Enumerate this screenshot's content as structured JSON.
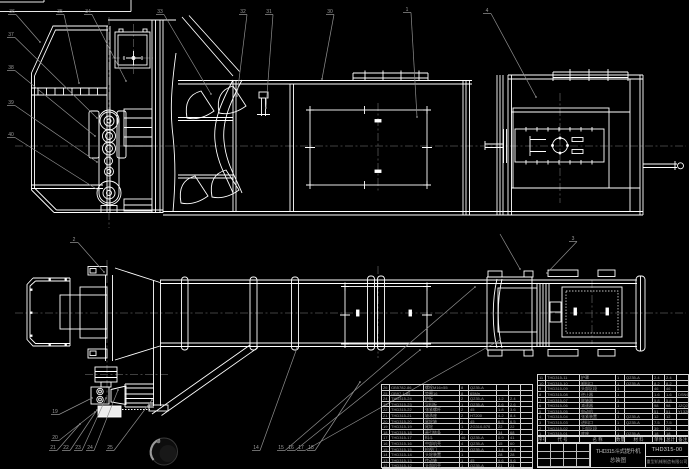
{
  "drawing": {
    "product_title": "THD315斗式提升机",
    "drawing_type": "总装图",
    "drawing_no": "THD315-00",
    "company": "重型机械制造有限公司"
  },
  "colors": {
    "background": "#000000",
    "line": "#ffffff",
    "annotation_gray": "#8f8f8f",
    "centerline_gray": "#565656",
    "table_text": "#a0a0a0"
  },
  "bom_headers": [
    "序号",
    "代  号",
    "名  称",
    "数量",
    "材  料",
    "单件",
    "总计",
    "备注"
  ],
  "bom_left": {
    "rows": [
      [
        "26",
        "GB5782-86",
        "螺栓M16×55",
        "8",
        "Q235-A",
        "",
        "",
        ""
      ],
      [
        "25",
        "GB97.1-85",
        "垫圈16",
        "8",
        "65Mn",
        "",
        "",
        ""
      ],
      [
        "24",
        "THD315-24",
        "护板",
        "2",
        "Q235-A",
        "1.2",
        "2.4",
        ""
      ],
      [
        "23",
        "THD315-23",
        "导料板",
        "1",
        "Q235-A",
        "2.6",
        "2.6",
        ""
      ],
      [
        "22",
        "THD315-22",
        "张紧螺杆",
        "2",
        "45",
        "1.8",
        "3.6",
        ""
      ],
      [
        "21",
        "THD315-21",
        "轴承座",
        "2",
        "HT200",
        "4.2",
        "8.4",
        ""
      ],
      [
        "20",
        "THD315-20",
        "尾轮轴",
        "1",
        "45",
        "6.5",
        "6.5",
        ""
      ],
      [
        "19",
        "THD315-19",
        "尾轮",
        "1",
        "ZG310-570",
        "22",
        "22",
        ""
      ],
      [
        "18",
        "THD315-18",
        "牵引链条",
        "2",
        "",
        "34",
        "68",
        ""
      ],
      [
        "17",
        "THD315-17",
        "料斗",
        "46",
        "Q235-A",
        "0.9",
        "41",
        ""
      ],
      [
        "16",
        "THD315-16",
        "中部机壳",
        "4",
        "Q235-A",
        "15",
        "60",
        ""
      ],
      [
        "15",
        "THD315-15",
        "检视门",
        "1",
        "Q235-A",
        "1.4",
        "1.4",
        ""
      ],
      [
        "14",
        "THD315-14",
        "头轮装置",
        "1",
        "",
        "28",
        "28",
        ""
      ],
      [
        "13",
        "THD315-13",
        "传动轴",
        "1",
        "45",
        "9.6",
        "9.6",
        ""
      ],
      [
        "12",
        "THD315-12",
        "头部机壳",
        "1",
        "Q235-A",
        "21",
        "21",
        ""
      ]
    ]
  },
  "bom_right": {
    "rows": [
      [
        "11",
        "THD315-11",
        "护罩",
        "1",
        "Q235-A",
        "2.4",
        "2.4",
        ""
      ],
      [
        "10",
        "THD315-10",
        "卸料口",
        "1",
        "Q235-A",
        "8.2",
        "8.2",
        ""
      ],
      [
        "9",
        "THD315-09",
        "头部区段",
        "1",
        "",
        "46",
        "46",
        ""
      ],
      [
        "8",
        "THD315-08",
        "逆止器",
        "1",
        "",
        "1.6",
        "1.6",
        "DSN60"
      ],
      [
        "7",
        "THD315-07",
        "联轴器",
        "1",
        "",
        "5.8",
        "5.8",
        ""
      ],
      [
        "6",
        "THD315-06",
        "减速器",
        "1",
        "",
        "98",
        "98",
        "JZQ250"
      ],
      [
        "5",
        "THD315-05",
        "电动机",
        "1",
        "",
        "51",
        "51",
        "Y132M-4"
      ],
      [
        "4",
        "THD315-04",
        "张紧装置",
        "1",
        "Q235-A",
        "12",
        "12",
        ""
      ],
      [
        "3",
        "THD315-03",
        "进料口",
        "1",
        "Q235-A",
        "7.5",
        "7.5",
        ""
      ],
      [
        "2",
        "THD315-02",
        "下部区段",
        "1",
        "",
        "39",
        "39",
        ""
      ],
      [
        "1",
        "THD315-01",
        "底座",
        "1",
        "Q235-A",
        "18",
        "18",
        ""
      ]
    ]
  },
  "balloons": [
    {
      "label": "36",
      "x": 12,
      "y": 10,
      "tx": 40,
      "ty": 42
    },
    {
      "label": "35",
      "x": 60,
      "y": 10,
      "tx": 79,
      "ty": 83
    },
    {
      "label": "34",
      "x": 88,
      "y": 10,
      "tx": 126,
      "ty": 81
    },
    {
      "label": "33",
      "x": 160,
      "y": 10,
      "tx": 211,
      "ty": 94
    },
    {
      "label": "32",
      "x": 243,
      "y": 10,
      "tx": 237,
      "ty": 96
    },
    {
      "label": "31",
      "x": 269,
      "y": 10,
      "tx": 266,
      "ty": 108
    },
    {
      "label": "30",
      "x": 330,
      "y": 10,
      "tx": 322,
      "ty": 79
    },
    {
      "label": "1",
      "x": 407,
      "y": 8,
      "tx": 417,
      "ty": 117
    },
    {
      "label": "4",
      "x": 487,
      "y": 9,
      "tx": 536,
      "ty": 97
    },
    {
      "label": "37",
      "x": 11,
      "y": 33,
      "tx": 97,
      "ty": 118
    },
    {
      "label": "38",
      "x": 11,
      "y": 66,
      "tx": 95,
      "ty": 136
    },
    {
      "label": "39",
      "x": 11,
      "y": 101,
      "tx": 97,
      "ty": 162
    },
    {
      "label": "40",
      "x": 11,
      "y": 133,
      "tx": 98,
      "ty": 190
    },
    {
      "label": "2",
      "x": 74,
      "y": 238,
      "tx": 104,
      "ty": 272
    },
    {
      "label": "3",
      "x": 573,
      "y": 237,
      "tx": 547,
      "ty": 273
    },
    {
      "label": "",
      "x": 500,
      "y": 234,
      "tx": 520,
      "ty": 269
    },
    {
      "label": "19",
      "x": 55,
      "y": 410,
      "tx": 92,
      "ty": 398
    },
    {
      "label": "20",
      "x": 55,
      "y": 436,
      "tx": 95,
      "ty": 412
    },
    {
      "label": "21",
      "x": 53,
      "y": 446,
      "tx": 80,
      "ty": 424
    },
    {
      "label": "22",
      "x": 66,
      "y": 446,
      "tx": 97,
      "ty": 410
    },
    {
      "label": "23",
      "x": 78,
      "y": 446,
      "tx": 106,
      "ty": 398
    },
    {
      "label": "24",
      "x": 90,
      "y": 446,
      "tx": 118,
      "ty": 390
    },
    {
      "label": "25",
      "x": 110,
      "y": 446,
      "tx": 152,
      "ty": 400
    },
    {
      "label": "14",
      "x": 256,
      "y": 446,
      "tx": 297,
      "ty": 348
    },
    {
      "label": "15",
      "x": 281,
      "y": 446,
      "tx": 475,
      "ty": 287
    },
    {
      "label": "16",
      "x": 291,
      "y": 446,
      "tx": 420,
      "ty": 350
    },
    {
      "label": "17",
      "x": 301,
      "y": 446,
      "tx": 500,
      "ty": 340
    },
    {
      "label": "18",
      "x": 311,
      "y": 446,
      "tx": 360,
      "ty": 382
    }
  ]
}
